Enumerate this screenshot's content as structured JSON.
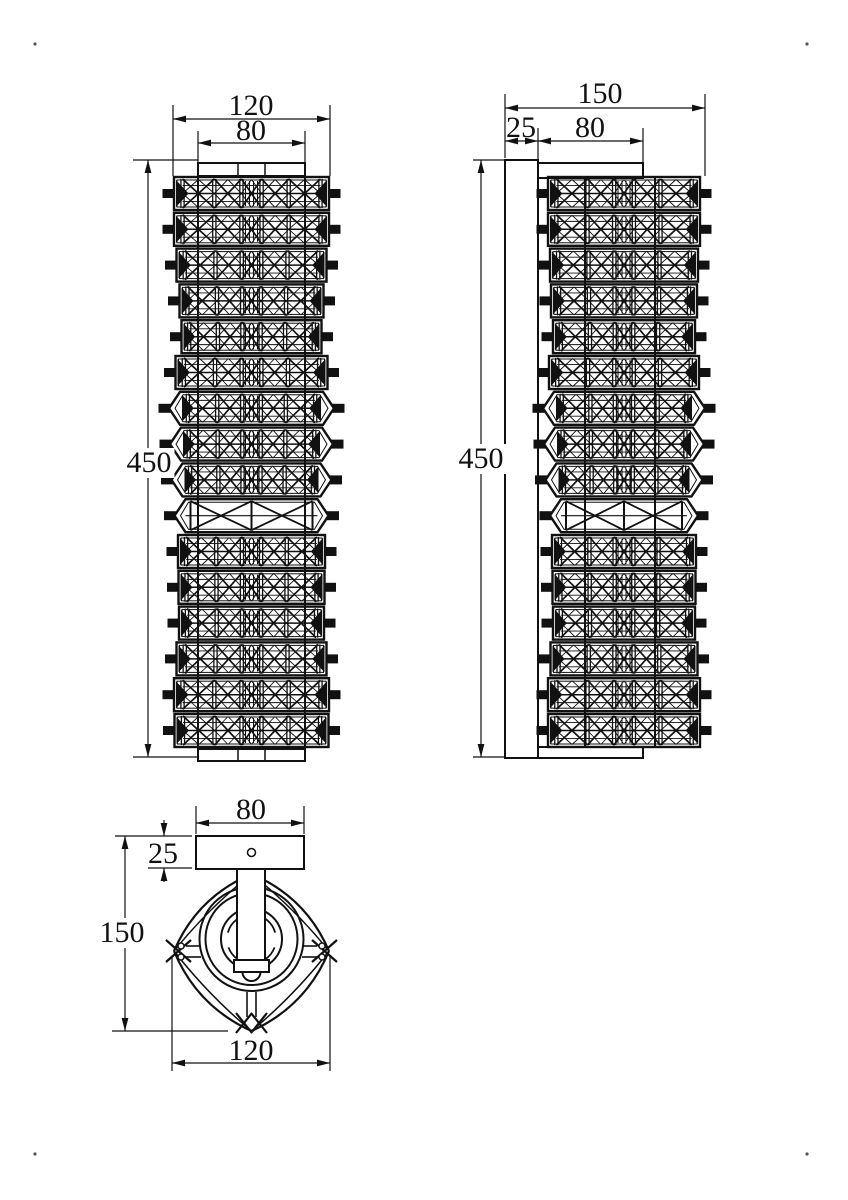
{
  "labels": {
    "front_overall_width": "120",
    "front_inner_width": "80",
    "front_height": "450",
    "side_overall_depth": "150",
    "side_backplate_depth": "25",
    "side_arm_length": "80",
    "side_height": "450",
    "bottom_backplate_width": "80",
    "bottom_backplate_depth": "25",
    "bottom_overall_depth": "150",
    "bottom_body_width": "120"
  },
  "geometry": {
    "ink": "#111111",
    "corner_marks": [
      [
        35,
        44
      ],
      [
        807,
        44
      ],
      [
        35,
        1154
      ],
      [
        807,
        1154
      ]
    ],
    "front": {
      "cx": 251.5,
      "dim_h": [
        {
          "y": 119,
          "x1": 173,
          "x2": 330
        },
        {
          "y": 143,
          "x1": 198,
          "x2": 305
        }
      ],
      "dim_v": [
        {
          "x": 148,
          "y1": 160,
          "y2": 757
        }
      ],
      "ext": [
        [
          173,
          105,
          173,
          176
        ],
        [
          330,
          105,
          330,
          176
        ],
        [
          198,
          131,
          198,
          162
        ],
        [
          305,
          131,
          305,
          162
        ],
        [
          133,
          160,
          198,
          160
        ],
        [
          133,
          757,
          198,
          757
        ]
      ],
      "rods": [
        [
          198,
          166,
          198,
          752
        ],
        [
          305,
          166,
          305,
          752
        ]
      ],
      "plates": [
        {
          "x": 198,
          "y": 163,
          "w": 107,
          "h": 13,
          "div": [
            238,
            265
          ]
        },
        {
          "x": 198,
          "y": 749,
          "w": 107,
          "h": 12,
          "div": [
            238,
            265
          ]
        }
      ],
      "rows_y0": 177,
      "row_pitch": 35.8,
      "row_h": 33,
      "rows": [
        {
          "w": 155,
          "s": "flat"
        },
        {
          "w": 155,
          "s": "flat"
        },
        {
          "w": 150,
          "s": "flat"
        },
        {
          "w": 144,
          "s": "flat"
        },
        {
          "w": 140,
          "s": "flat"
        },
        {
          "w": 152,
          "s": "flat"
        },
        {
          "w": 143,
          "s": "point"
        },
        {
          "w": 141,
          "s": "point"
        },
        {
          "w": 138,
          "s": "point"
        },
        {
          "w": 132,
          "s": "sparse"
        },
        {
          "w": 147,
          "s": "flat"
        },
        {
          "w": 146,
          "s": "flat"
        },
        {
          "w": 145,
          "s": "flat"
        },
        {
          "w": 150,
          "s": "flat"
        },
        {
          "w": 155,
          "s": "flat"
        },
        {
          "w": 154,
          "s": "flat"
        }
      ]
    },
    "side": {
      "cx": 624,
      "dim_h": [
        {
          "y": 108,
          "x1": 505,
          "x2": 705
        },
        {
          "y": 141,
          "x1": 505,
          "x2": 538
        },
        {
          "y": 141,
          "x1": 538,
          "x2": 643
        }
      ],
      "dim_v": [
        {
          "x": 481,
          "y1": 160,
          "y2": 757
        }
      ],
      "ext": [
        [
          505,
          94,
          505,
          158
        ],
        [
          705,
          94,
          705,
          176
        ],
        [
          538,
          128,
          538,
          162
        ],
        [
          643,
          128,
          643,
          162
        ],
        [
          473,
          160,
          505,
          160
        ],
        [
          473,
          757,
          505,
          757
        ]
      ],
      "wall_plate": {
        "x": 505,
        "y": 160,
        "w": 33,
        "h": 598
      },
      "arms": [
        {
          "x": 538,
          "y": 163,
          "w": 105,
          "h": 15
        },
        {
          "x": 538,
          "y": 747,
          "w": 105,
          "h": 11
        }
      ],
      "rods": [
        [
          585,
          178,
          585,
          746
        ],
        [
          655,
          178,
          655,
          746
        ]
      ],
      "rows_y0": 177,
      "row_pitch": 35.8,
      "row_h": 33,
      "rows": [
        {
          "w": 152,
          "s": "flat"
        },
        {
          "w": 152,
          "s": "flat"
        },
        {
          "w": 148,
          "s": "flat"
        },
        {
          "w": 146,
          "s": "flat"
        },
        {
          "w": 142,
          "s": "flat"
        },
        {
          "w": 150,
          "s": "flat"
        },
        {
          "w": 140,
          "s": "point"
        },
        {
          "w": 138,
          "s": "point"
        },
        {
          "w": 135,
          "s": "point"
        },
        {
          "w": 126,
          "s": "sparse"
        },
        {
          "w": 144,
          "s": "flat"
        },
        {
          "w": 143,
          "s": "flat"
        },
        {
          "w": 142,
          "s": "flat"
        },
        {
          "w": 147,
          "s": "flat"
        },
        {
          "w": 152,
          "s": "flat"
        },
        {
          "w": 152,
          "s": "flat"
        }
      ]
    },
    "bottom": {
      "center": [
        251.5,
        939
      ],
      "plate": {
        "x": 196,
        "y": 836,
        "w": 108,
        "h": 33
      },
      "hole": {
        "cx": 251.5,
        "cy": 852.5,
        "r": 4
      },
      "stem": {
        "x": 237,
        "y": 869,
        "w": 28,
        "h": 93
      },
      "flange": {
        "x": 234,
        "y": 960,
        "w": 35,
        "h": 12
      },
      "tip": {
        "cx": 251.5,
        "cy": 972,
        "r": 9
      },
      "circles": [
        52,
        46
      ],
      "ring_r": 30.5,
      "arcs": [
        {
          "r": 24.5,
          "a1": 15,
          "a2": 165
        },
        {
          "r": 24.5,
          "a1": 200,
          "a2": 340
        }
      ],
      "diamond": {
        "L": [
          174,
          951
        ],
        "T": [
          251.5,
          874
        ],
        "R": [
          329,
          951
        ],
        "B": [
          251.5,
          1031
        ],
        "bulge_outer": 11,
        "bulge_inner": 3
      },
      "spokes": [
        [
          186,
          946,
          201,
          946
        ],
        [
          186,
          957,
          201,
          957
        ],
        [
          302,
          946,
          317,
          946
        ],
        [
          302,
          957,
          317,
          957
        ],
        [
          247,
          992,
          247,
          1017
        ],
        [
          256,
          992,
          256,
          1017
        ]
      ],
      "clips": [
        [
          166,
          940,
          191,
          962
        ],
        [
          166,
          962,
          191,
          940
        ],
        [
          312,
          940,
          337,
          962
        ],
        [
          312,
          962,
          337,
          940
        ],
        [
          236,
          1013,
          252,
          1033
        ],
        [
          236,
          1033,
          252,
          1013
        ],
        [
          251,
          1013,
          267,
          1033
        ],
        [
          251,
          1033,
          267,
          1013
        ]
      ],
      "beads": [
        [
          181,
          946,
          3
        ],
        [
          181,
          957,
          3
        ],
        [
          322,
          946,
          3
        ],
        [
          322,
          957,
          3
        ]
      ],
      "dim_h": [
        {
          "y": 823,
          "x1": 196,
          "x2": 304
        },
        {
          "y": 1063,
          "x1": 172,
          "x2": 330
        }
      ],
      "dim_v": [
        {
          "x": 125,
          "y1": 836,
          "y2": 1031
        }
      ],
      "dim_small": {
        "x": 164,
        "y1": 836,
        "y2": 868
      },
      "ext": [
        [
          196,
          806,
          196,
          834
        ],
        [
          304,
          806,
          304,
          834
        ],
        [
          115,
          836,
          192,
          836
        ],
        [
          148,
          868,
          192,
          868
        ],
        [
          112,
          1031,
          228,
          1031
        ],
        [
          172,
          957,
          172,
          1071
        ],
        [
          330,
          957,
          330,
          1071
        ]
      ]
    }
  }
}
